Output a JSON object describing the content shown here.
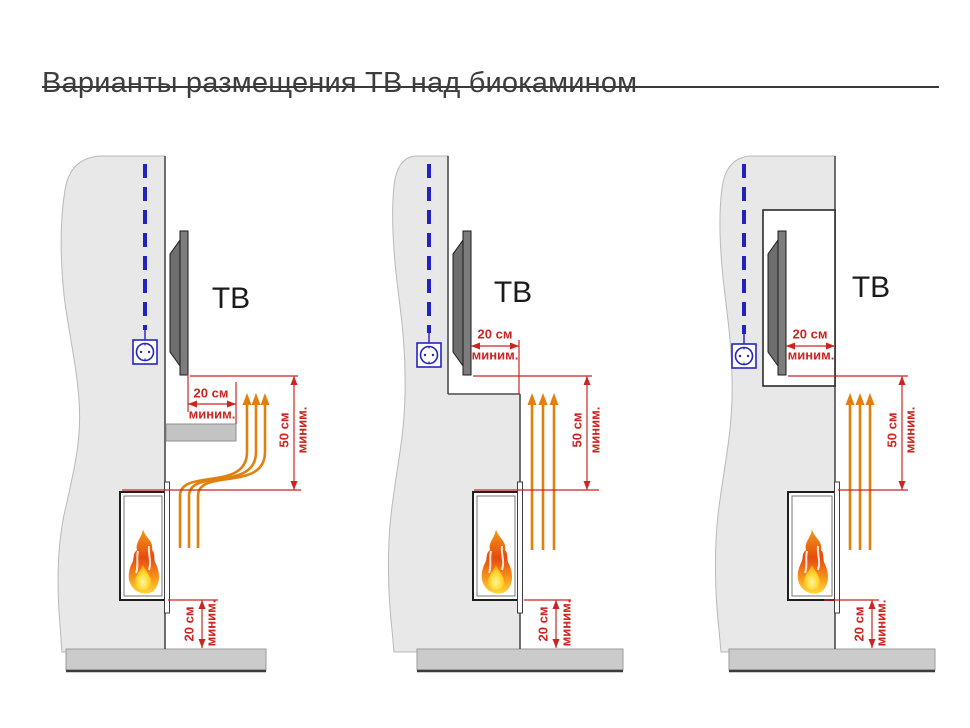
{
  "title": "Варианты размещения ТВ над биокамином",
  "colors": {
    "dimension_red": "#cc2420",
    "heat_orange": "#e0810f",
    "cable_blue": "#2222bd",
    "wall_gray": "#e8e8e8",
    "floor_gray": "#cbcbcb",
    "tv_gray": "#7d7d7d"
  },
  "panels": [
    {
      "id": "tv-above-shelf",
      "tv_label": "ТВ",
      "dims": {
        "shelf_overhang": {
          "value": "20 см",
          "qualifier": "миним."
        },
        "tv_to_fireplace": {
          "value": "50 см",
          "qualifier": "миним."
        },
        "fireplace_to_floor": {
          "value": "20 см",
          "qualifier": "миним."
        }
      }
    },
    {
      "id": "tv-recessed-step",
      "tv_label": "ТВ",
      "dims": {
        "tv_setback": {
          "value": "20 см",
          "qualifier": "миним."
        },
        "tv_to_fireplace": {
          "value": "50 см",
          "qualifier": "миним."
        },
        "fireplace_to_floor": {
          "value": "20 см",
          "qualifier": "миним."
        }
      }
    },
    {
      "id": "tv-in-niche",
      "tv_label": "ТВ",
      "dims": {
        "niche_depth": {
          "value": "20 см",
          "qualifier": "миним."
        },
        "tv_to_fireplace": {
          "value": "50 см",
          "qualifier": "миним."
        },
        "fireplace_to_floor": {
          "value": "20 см",
          "qualifier": "миним."
        }
      }
    }
  ]
}
